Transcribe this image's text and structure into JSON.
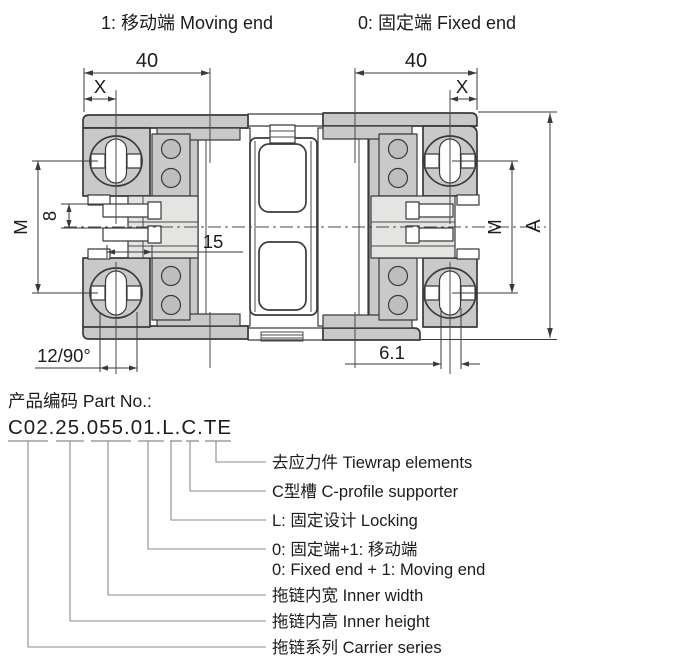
{
  "header": {
    "moving_end": "1: 移动端 Moving end",
    "fixed_end": "0: 固定端 Fixed end"
  },
  "dims": {
    "width_left": "40",
    "width_right": "40",
    "x_left": "X",
    "x_right": "X",
    "m_left": "M",
    "m_right": "M",
    "pin_pitch": "8",
    "pin_length": "15",
    "overall_height": "A",
    "bottom_left": "12/90°",
    "bottom_right": "6.1"
  },
  "part": {
    "heading": "产品编码 Part No.:",
    "number": "C02.25.055.01.L.C.TE",
    "breakdown": [
      {
        "code": "TE",
        "label": "去应力件 Tiewrap elements"
      },
      {
        "code": "C",
        "label": "C型槽 C-profile supporter"
      },
      {
        "code": "L",
        "label": "L: 固定设计 Locking"
      },
      {
        "code": "01",
        "label": "0: 固定端+1: 移动端",
        "label_en": "0: Fixed end + 1: Moving end"
      },
      {
        "code": "055",
        "label": "拖链内宽 Inner width"
      },
      {
        "code": "25",
        "label": "拖链内高 Inner height"
      },
      {
        "code": "C02",
        "label": "拖链系列 Carrier series"
      }
    ]
  },
  "colors": {
    "body_gray": "#c9c9c9",
    "panel_gray": "#e4e5e3",
    "circle_gray": "#bdbfbd",
    "line": "#3a3a3a",
    "leader_gray": "#8b8b8b"
  }
}
